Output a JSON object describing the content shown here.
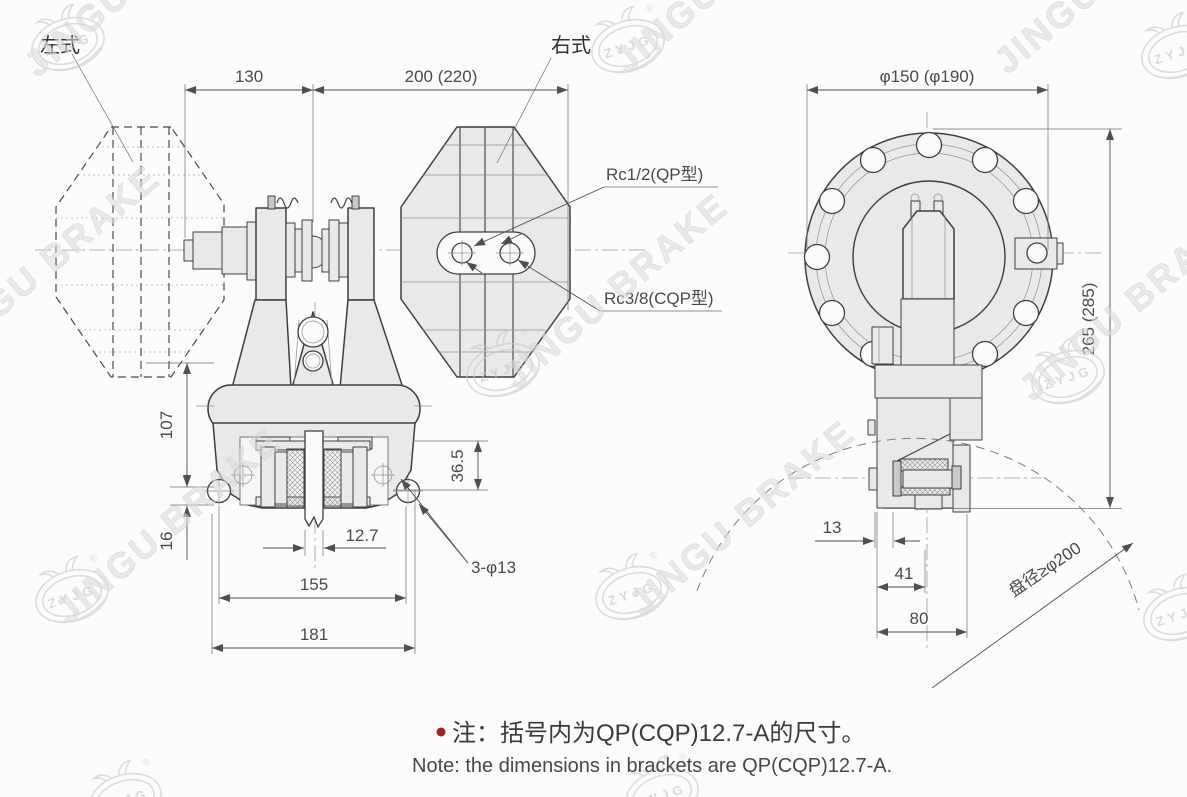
{
  "labels": {
    "left_type": "左式",
    "right_type": "右式",
    "port_top": "Rc1/2(QP型)",
    "port_bottom": "Rc3/8(CQP型)",
    "mount_holes": "3-φ13",
    "disc_diameter": "盘径≥φ200"
  },
  "dimensions": {
    "front": {
      "d130": "130",
      "d200": "200 (220)",
      "d107": "107",
      "d16": "16",
      "d12_7": "12.7",
      "d155": "155",
      "d181": "181",
      "d36_5": "36.5"
    },
    "side": {
      "d150": "φ150 (φ190)",
      "d265": "265 (285)",
      "d13": "13",
      "d41": "41",
      "d80": "80"
    }
  },
  "note": {
    "zh": "注：括号内为QP(CQP)12.7-A的尺寸。",
    "en": "Note:  the dimensions in brackets are QP(CQP)12.7-A.",
    "bullet_color": "#a3241f"
  },
  "watermarks": {
    "brand": "JINGU BRAKE",
    "logo_text": "ZYJG",
    "registered": "®"
  },
  "colors": {
    "outline": "#3f3f3f",
    "fill_light": "#e9e9e7",
    "dimension_text": "#4a4a4a",
    "thin_line": "#8f8f8f",
    "watermark": "#c6c6c6",
    "background": "#fcfcfc"
  }
}
